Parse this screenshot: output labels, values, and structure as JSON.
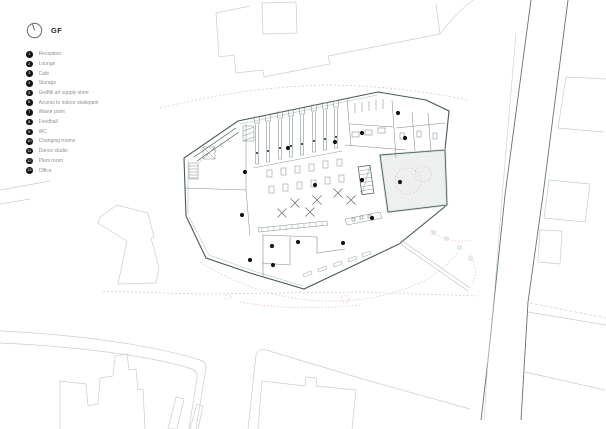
{
  "page": {
    "title": "GF"
  },
  "legend": {
    "items": [
      {
        "number": "1",
        "label": "Reception"
      },
      {
        "number": "2",
        "label": "Lounge"
      },
      {
        "number": "3",
        "label": "Cafe"
      },
      {
        "number": "4",
        "label": "Storage"
      },
      {
        "number": "5",
        "label": "Graffiti art supply store"
      },
      {
        "number": "6",
        "label": "Access to indoor skatepark"
      },
      {
        "number": "7",
        "label": "Waste point"
      },
      {
        "number": "8",
        "label": "Foodhall"
      },
      {
        "number": "9",
        "label": "WC"
      },
      {
        "number": "10",
        "label": "Changing rooms"
      },
      {
        "number": "11",
        "label": "Dance studio"
      },
      {
        "number": "12",
        "label": "Plant room"
      },
      {
        "number": "13",
        "label": "Office"
      }
    ]
  },
  "plan": {
    "markers": [
      {
        "x": 245,
        "y": 172
      },
      {
        "x": 242,
        "y": 215
      },
      {
        "x": 288,
        "y": 148
      },
      {
        "x": 335,
        "y": 142
      },
      {
        "x": 315,
        "y": 185
      },
      {
        "x": 362,
        "y": 133
      },
      {
        "x": 398,
        "y": 113
      },
      {
        "x": 405,
        "y": 138
      },
      {
        "x": 400,
        "y": 182
      },
      {
        "x": 362,
        "y": 180
      },
      {
        "x": 372,
        "y": 218
      },
      {
        "x": 298,
        "y": 242
      },
      {
        "x": 343,
        "y": 243
      },
      {
        "x": 273,
        "y": 265
      },
      {
        "x": 250,
        "y": 260
      },
      {
        "x": 272,
        "y": 246
      }
    ]
  },
  "colors": {
    "context": "#c7cecc",
    "road": "#5e7477",
    "building": "#46585a",
    "interior": "#7e8c8d",
    "accent_dashed": "#e2b0ae",
    "room_fill": "#edf0ef",
    "marker": "#141414",
    "legend_text": "#8b918f",
    "title_text": "#282828"
  }
}
